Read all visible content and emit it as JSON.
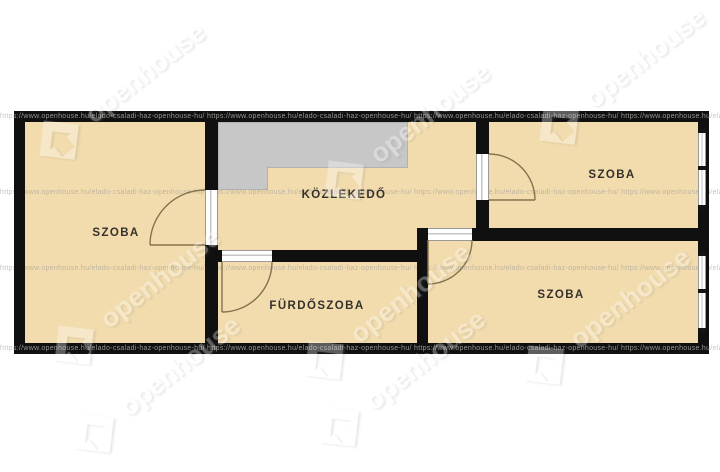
{
  "page": {
    "type": "real-estate floor plan",
    "background": "#ffffff"
  },
  "rooms": [
    {
      "id": "szoba-left",
      "label": "SZOBA"
    },
    {
      "id": "kozlekedo",
      "label": "KÖZLEKEDŐ"
    },
    {
      "id": "szoba-top-right",
      "label": "SZOBA"
    },
    {
      "id": "furdoszoba",
      "label": "FÜRDŐSZOBA"
    },
    {
      "id": "szoba-bottom-right",
      "label": "SZOBA"
    }
  ],
  "watermark": {
    "brand": "openhouse",
    "url_line": "https://www.openhouse.hu/elado-csaladi-haz-openhouse-hu/ https://www.openhouse.hu/elado-csaladi-haz-openhouse-hu/ https://www.openhouse.hu/elado-csaladi-haz-openhouse-hu/ https://www.openhouse.hu/elado-csaladi-haz-openhouse-hu/ https://www.openhouse.hu/elado-csaladi-haz-openhouse-hu/"
  },
  "colors": {
    "wall": "#101010",
    "floor": "#f2dcae",
    "stairs": "#c7c7c7",
    "door_arc": "#84734e",
    "label_text": "#35312a"
  }
}
